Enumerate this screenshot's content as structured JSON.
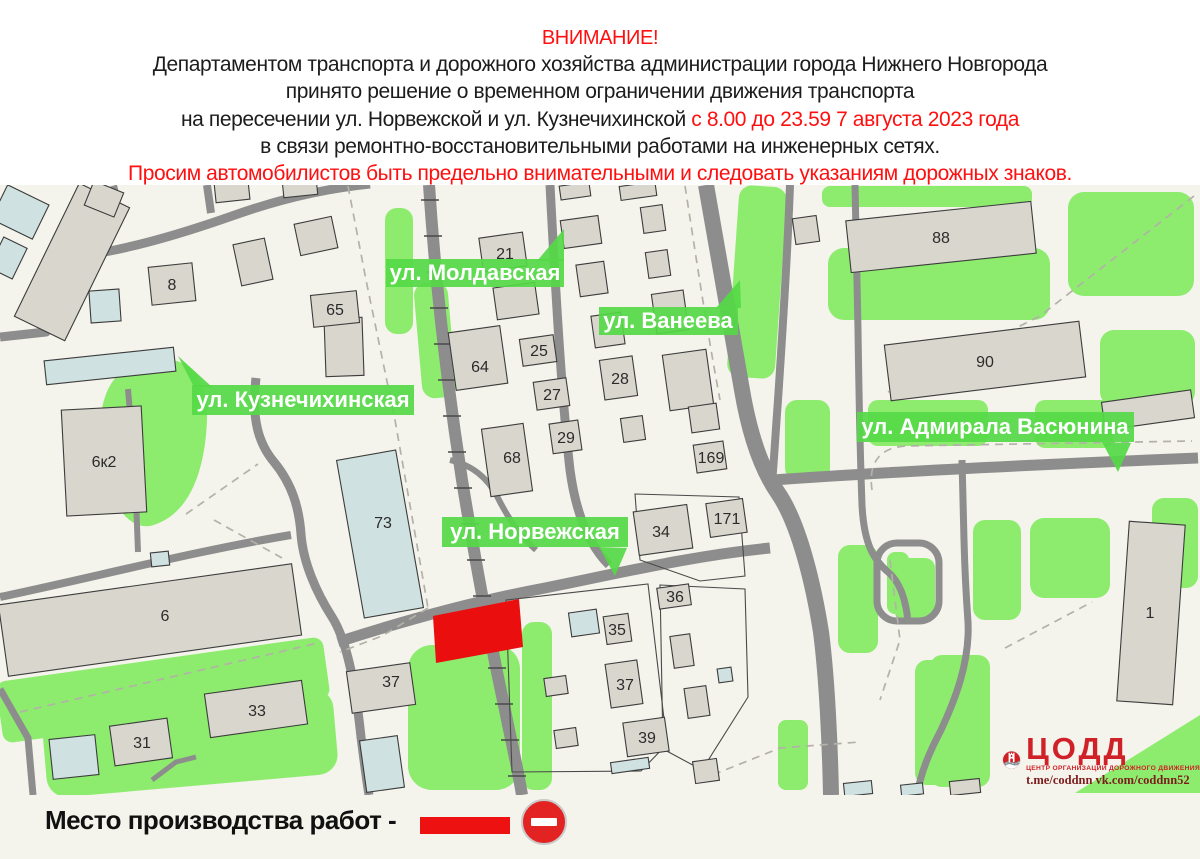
{
  "header": {
    "attention": "ВНИМАНИЕ!",
    "line1": "Департаментом транспорта и дорожного хозяйства администрации города Нижнего Новгорода",
    "line2": "принято решение о временном ограничении движения транспорта",
    "line3_black": "на пересечении ул. Норвежской и ул. Кузнечихинской",
    "line3_red": "с 8.00 до 23.59  7 августа 2023 года",
    "line4": "в связи ремонтно-восстановительными работами на инженерных сетях.",
    "line5": "Просим автомобилистов быть предельно внимательными и следовать указаниям дорожных знаков."
  },
  "map": {
    "street_labels": [
      {
        "label": "ул. Молдавская"
      },
      {
        "label": "ул. Ванеева"
      },
      {
        "label": "ул. Кузнечихинская"
      },
      {
        "label": "ул. Норвежская"
      },
      {
        "label": "ул. Адмирала Васюнина"
      }
    ],
    "buildings": [
      {
        "number": "8"
      },
      {
        "number": "65"
      },
      {
        "number": "21"
      },
      {
        "number": "88"
      },
      {
        "number": "90"
      },
      {
        "number": "64"
      },
      {
        "number": "25"
      },
      {
        "number": "27"
      },
      {
        "number": "28"
      },
      {
        "number": "29"
      },
      {
        "number": "68"
      },
      {
        "number": "169"
      },
      {
        "number": "171"
      },
      {
        "number": "34"
      },
      {
        "number": "73"
      },
      {
        "number": "6к2"
      },
      {
        "number": "6"
      },
      {
        "number": "36"
      },
      {
        "number": "35"
      },
      {
        "number": "37"
      },
      {
        "number": "37"
      },
      {
        "number": "33"
      },
      {
        "number": "31"
      },
      {
        "number": "39"
      },
      {
        "number": "1"
      }
    ]
  },
  "legend": {
    "label": "Место производства работ  -"
  },
  "logo": {
    "acronym": "ЦОДД",
    "subtitle": "ЦЕНТР ОРГАНИЗАЦИИ ДОРОЖНОГО ДВИЖЕНИЯ",
    "links": "t.me/coddnn vk.com/coddnn52"
  },
  "colors": {
    "alert_red": "#ff0f0f",
    "work_zone_red": "#ea0e0e",
    "label_green": "#55d947",
    "area_green": "#8dec6e",
    "road_gray": "#8d8d8d",
    "building_gray": "#d9d6ce",
    "building_blue": "#cfe1e0",
    "logo_red": "#cf2127"
  }
}
